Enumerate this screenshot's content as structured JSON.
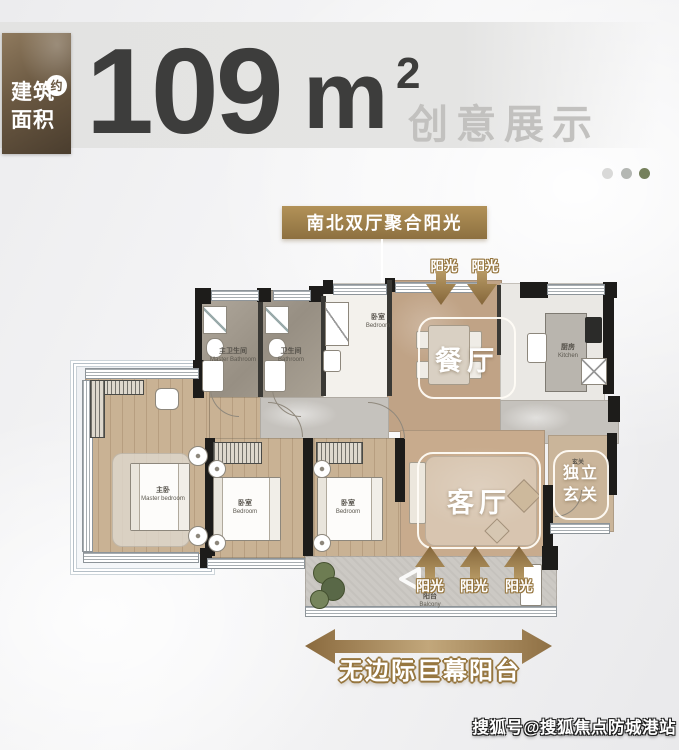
{
  "header": {
    "area_label": {
      "line1": "建筑",
      "line2": "面积",
      "approx": "约"
    },
    "area": {
      "number": "109",
      "unit": "m",
      "superscript": "2"
    },
    "subtitle": "创意展示",
    "pager_dot_colors": [
      "#d9d9d8",
      "#b4b7b3",
      "#75805c"
    ]
  },
  "callout": {
    "title": "南北双厅聚合阳光"
  },
  "sunlight": {
    "top_labels": [
      "阳光",
      "阳光"
    ],
    "bottom_labels": [
      "阳光",
      "阳光",
      "阳光"
    ]
  },
  "banner": {
    "label": "无边际巨幕阳台"
  },
  "floorplan": {
    "master_bathroom": {
      "zh": "主卫生间",
      "en": "Master Bathroom"
    },
    "bathroom": {
      "zh": "卫生间",
      "en": "Bathroom"
    },
    "bedroom_north": {
      "zh": "卧室",
      "en": "Bedroom"
    },
    "kitchen": {
      "zh": "厨房",
      "en": "Kitchen"
    },
    "dining_room": {
      "zh": "餐厅"
    },
    "living_room": {
      "zh": "客厅"
    },
    "master_bedroom": {
      "zh": "主卧",
      "en": "Master bedroom"
    },
    "bedroom_2": {
      "zh": "卧室",
      "en": "Bedroom"
    },
    "bedroom_3": {
      "zh": "卧室",
      "en": "Bedroom"
    },
    "balcony": {
      "zh": "阳台",
      "en": "Balcony"
    },
    "foyer": {
      "zh": "玄关"
    },
    "entrance_tag": {
      "line1": "独立",
      "line2": "玄关"
    }
  },
  "watermark": {
    "text": "搜狐号@搜狐焦点防城港站"
  },
  "colors": {
    "bronze": "#96763f",
    "gold_box": "#a58753",
    "number_dark": "#3d3d3c",
    "subtitle_gray": "#c2c1bf"
  }
}
